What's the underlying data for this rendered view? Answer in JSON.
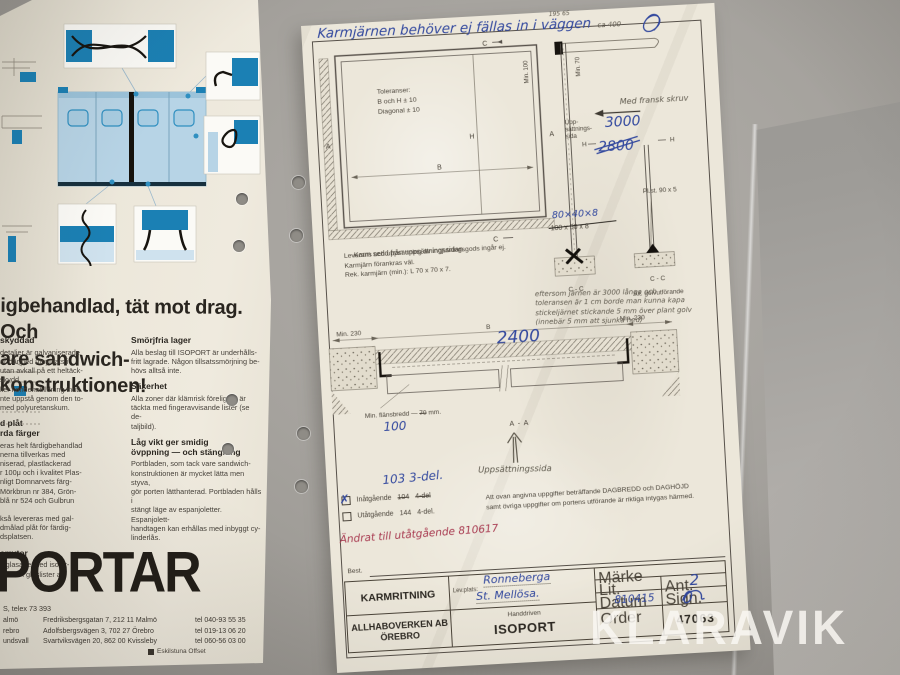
{
  "watermark": {
    "text": "KLARAVIK"
  },
  "brochure": {
    "headline": "igbehandlad, tät mot drag. Och\nare sandwich-konstruktionen!",
    "col1": [
      {
        "heading": "skyddad",
        "body": "detaljer är galvaniserade.\nar därmed utnyttjats i\nutan avkall på ett heltäck-\nskydd.\nller kondensbildning inuti\nnte uppstå genom den to-\nmed polyuretanskum."
      },
      {
        "heading": "d plåt\nrda färger",
        "body": "eras helt färdigbehandlad\nnerna tillverkas med\nniserad, plastlackerad\nr 100μ och i kvalitet Plas-\nnligt Domnarvets färg-\nMörkbrun nr 384, Grön-\nblå nr 524 och Gulbrun\n\nkså levereras med gal-\ndmålad plåt för färdig-\ndsplatsen."
      },
      {
        "heading": "errutor",
        "body": "s glasade med isoler-\nattade i glaslister av"
      }
    ],
    "col2": [
      {
        "heading": "Smörjfria lager",
        "body": "Alla beslag till ISOPORT är underhålls-\nfritt lagrade. Någon tillsatssmörjning be-\nhövs alltså inte."
      },
      {
        "heading": "Säkerhet",
        "body": "Alla zoner där klämrisk föreligger är\ntäckta med fingeravvisande lister (se de-\ntaljbild)."
      },
      {
        "heading": "Låg vikt ger smidig\növppning — och stängning",
        "body": "Portbladen, som tack vare sandwich-\nkonstruktionen är mycket lätta men styva,\ngör porten lätthanterad. Portbladen hålls i\nstängt läge av espanjoletter. Espanjolett-\nhandtagen kan erhållas med inbyggt cy-\nlinderlås."
      }
    ],
    "logo": "PORTAR",
    "telex": "S, telex 73 393",
    "addresses": [
      {
        "city": "almö",
        "street": "Fredriksbergsgatan 7, 212 11 Malmö",
        "tel": "tel 040-93 55 35"
      },
      {
        "city": "rebro",
        "street": "Adolfsbergsvägen 3, 702 27 Örebro",
        "tel": "tel 019-13 06 20"
      },
      {
        "city": "undsvall",
        "street": "Svartviksvägen 20, 862 00 Kvissleby",
        "tel": "tel 060-56 03 00"
      }
    ],
    "printer": "Eskilstuna Offset"
  },
  "drawing": {
    "note_top": "Karmjärnen behöver ej fällas in i väggen",
    "note_small": "195 65",
    "note_ca": "ca 400",
    "note_screw": "Med fransk skruv",
    "front_view": {
      "tol1": "Toleranser:",
      "tol2": "B och H  ± 10",
      "tol3": "Diagonal ± 10",
      "label_a": "A",
      "label_c": "C",
      "label_h": "H",
      "label_b": "B",
      "caption": "Karm sedd från uppsättningssidan."
    },
    "section": {
      "min100": "Min. 100",
      "min70": "Min. 70",
      "upps": "Upp-\nsättnings-\nsida",
      "hw3000": "3000",
      "h_label": "H",
      "hw2800": "2800",
      "hw80": "80×40×8",
      "old100": "100 x 50 x 8",
      "plst": "Pl.st. 90 x 5",
      "cc": "C - C",
      "alt_golv": "Alt. golvutförande"
    },
    "leverans": "Leverans och uppsättning av ingjutningsgods ingår ej.\nKarmjärn förankras väl.\nRek. karmjärn (min.): L 70 x 70 x 7.",
    "pencil_note": "eftersom järnen är 3000 långa och\ntoleransen är 1 cm borde man kunna kapa\nstickeljärnet stickande 5 mm över plant golv\n(innebär 5 mm att sjunka ned)",
    "plan": {
      "min230": "Min. 230",
      "b": "B",
      "hw2400": "2400",
      "flans": "Min. flänsbredd —",
      "flans_old": "70",
      "flans_unit": "mm.",
      "hw100": "100",
      "aa": "A - A",
      "upps_pencil": "Uppsättningssida"
    },
    "variants": {
      "hw103": "103 3-del.",
      "checked_mark": "✗",
      "in_label": "Inåtgående",
      "in_code": "104",
      "in_del": "4-del",
      "ut_label": "Utåtgående",
      "ut_code": "144",
      "ut_del": "4-del."
    },
    "intyg": "Att ovan angivna uppgifter beträffande DAGBREDD och DAGHÖJD\nsamt övriga uppgifter om portens utförande är riktiga intygas härmed.",
    "red_note": "Ändrat till utåtgående 810617",
    "titleblock": {
      "best": "Best.",
      "title": "KARMRITNING",
      "company": "ALLHABOVERKEN AB\nÖREBRO",
      "levplats_label": "Lev.plats:",
      "lev1": "Ronneberga",
      "lev2": "St. Mellösa.",
      "handdriven": "Handdriven",
      "product": "ISOPORT",
      "marke": "Märke",
      "lit": "Lit.",
      "ant": "Ant.",
      "ant_value": "2",
      "datum": "Datum",
      "datum_value": "810415",
      "sign": "Sign.",
      "order": "Order",
      "order_value": "47063"
    }
  }
}
